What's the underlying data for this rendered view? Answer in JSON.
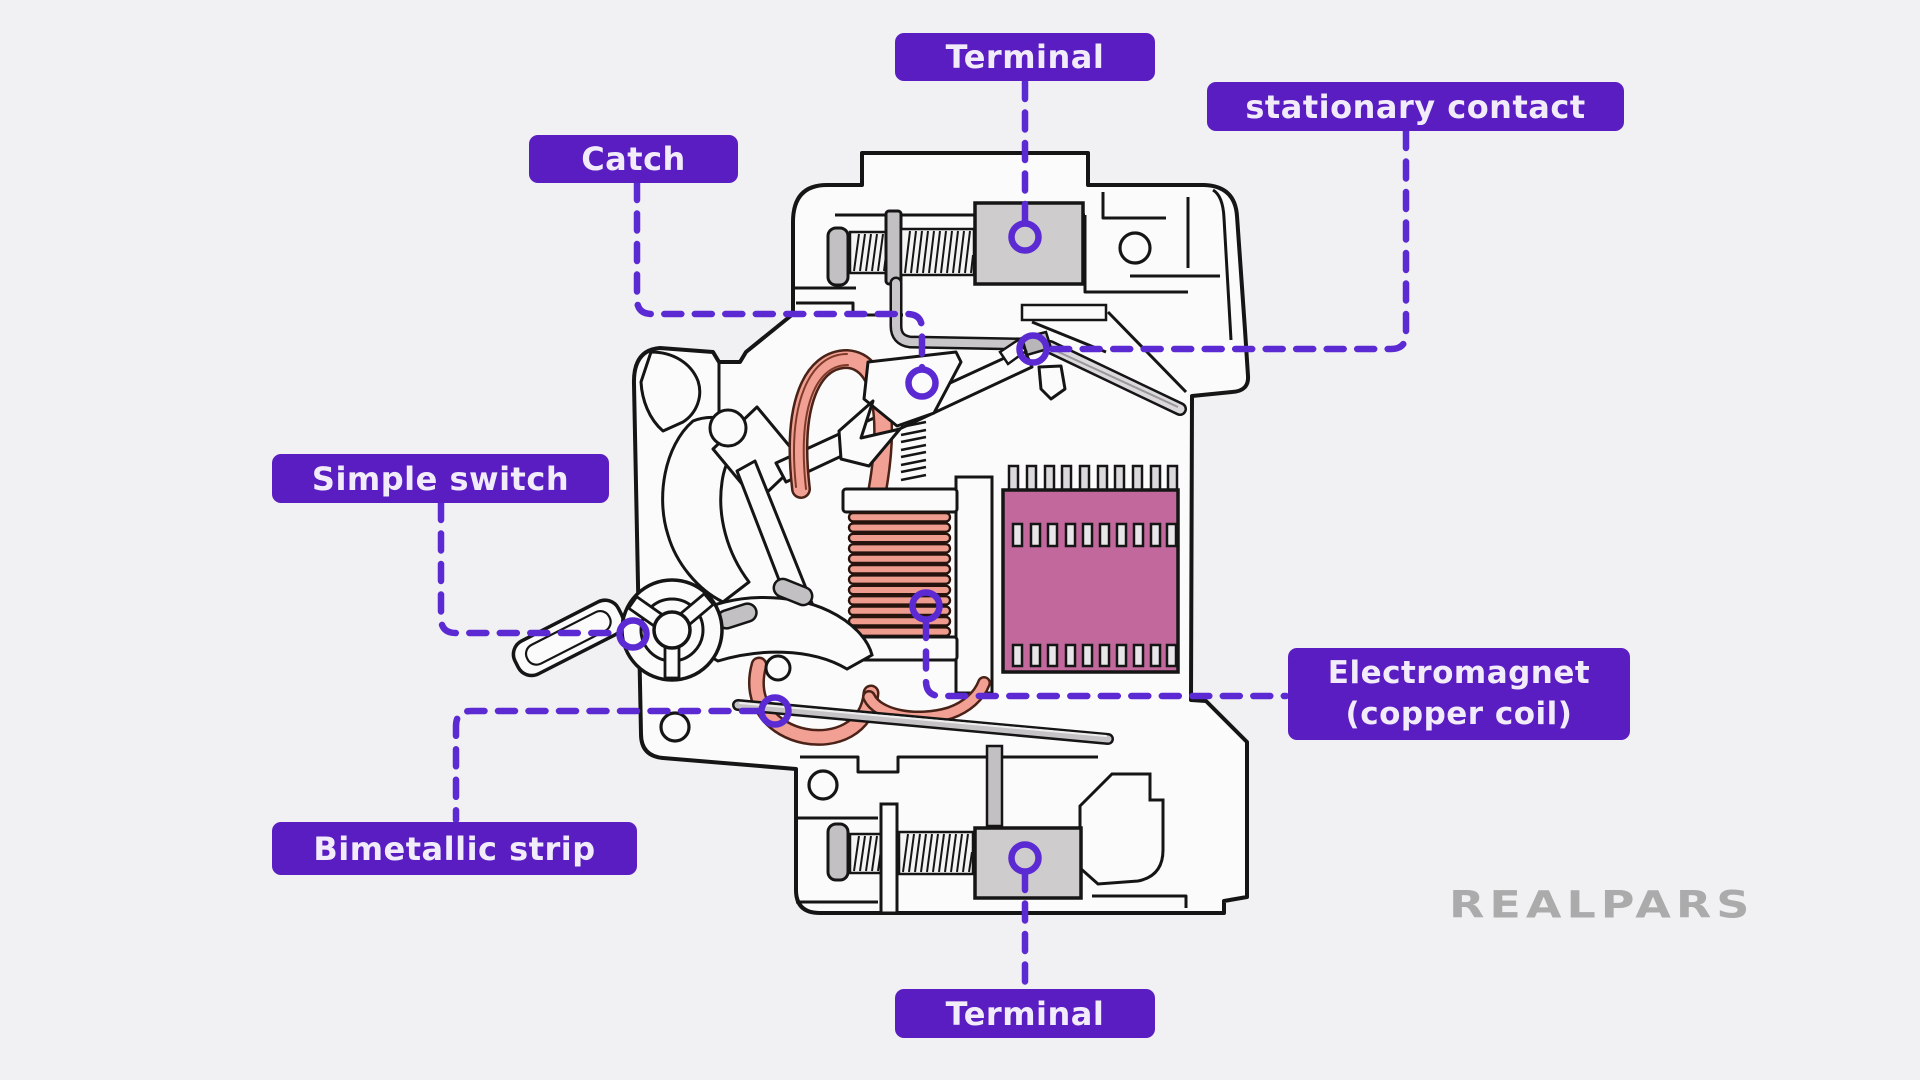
{
  "figure": {
    "title_visible": false,
    "type": "labeled cutaway diagram of a miniature circuit breaker (MCB)"
  },
  "labels": {
    "terminal_top": "Terminal",
    "stationary_contact": "stationary contact",
    "catch": "Catch",
    "simple_switch": "Simple switch",
    "electromagnet_line1": "Electromagnet",
    "electromagnet_line2": "(copper coil)",
    "bimetallic_strip": "Bimetallic strip",
    "terminal_bottom": "Terminal"
  },
  "watermark": "REALPARS",
  "colors": {
    "background": "#f1f0f2",
    "label_purple": "#5a1dc2",
    "leader_purple": "#5b2ad2",
    "label_text": "#f2ecfa",
    "line_art": "#151515",
    "coil_salmon": "#ef9c8e",
    "wire_salmon": "#f2a093",
    "arc_chute_pink": "#c2689c",
    "metal_gray": "#c3c0c3",
    "terminal_gray": "#cfccce",
    "watermark_gray": "#ababab"
  },
  "parts": [
    "Terminal",
    "stationary contact",
    "Catch",
    "Simple switch",
    "Electromagnet (copper coil)",
    "Bimetallic strip",
    "Terminal"
  ]
}
